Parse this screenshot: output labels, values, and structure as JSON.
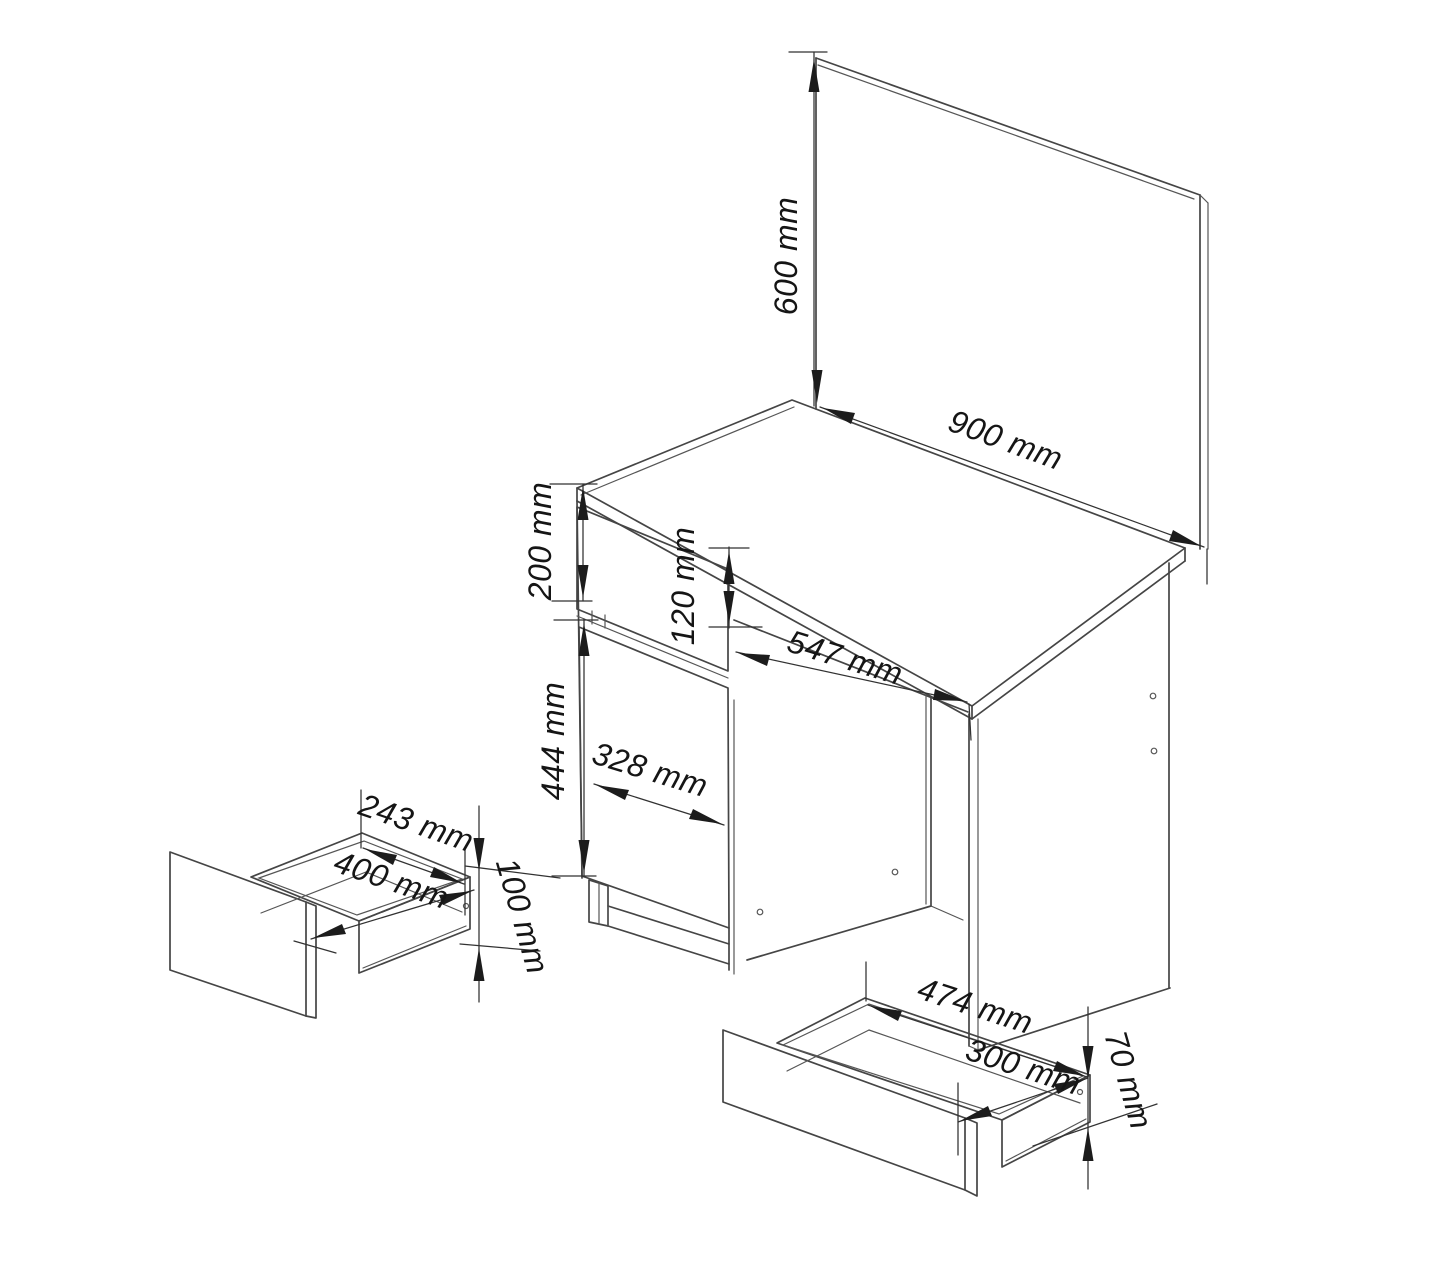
{
  "diagram": {
    "kind": "furniture-assembly-dimension-drawing",
    "unit": "mm",
    "background_color": "#ffffff",
    "line_color": "#454545",
    "text_color": "#151515",
    "mirror": {
      "height_label": "600 mm",
      "width_label": "900 mm"
    },
    "desk": {
      "drawer_front_height_label": "200 mm",
      "apron_height_label": "120 mm",
      "kneehole_width_label": "547 mm",
      "door_height_label": "444 mm",
      "door_width_label": "328 mm"
    },
    "small_drawer": {
      "inner_width_label": "243 mm",
      "depth_label": "400 mm",
      "height_label": "100 mm"
    },
    "large_drawer": {
      "width_label": "474 mm",
      "depth_label": "300 mm",
      "height_label": "70 mm"
    }
  }
}
